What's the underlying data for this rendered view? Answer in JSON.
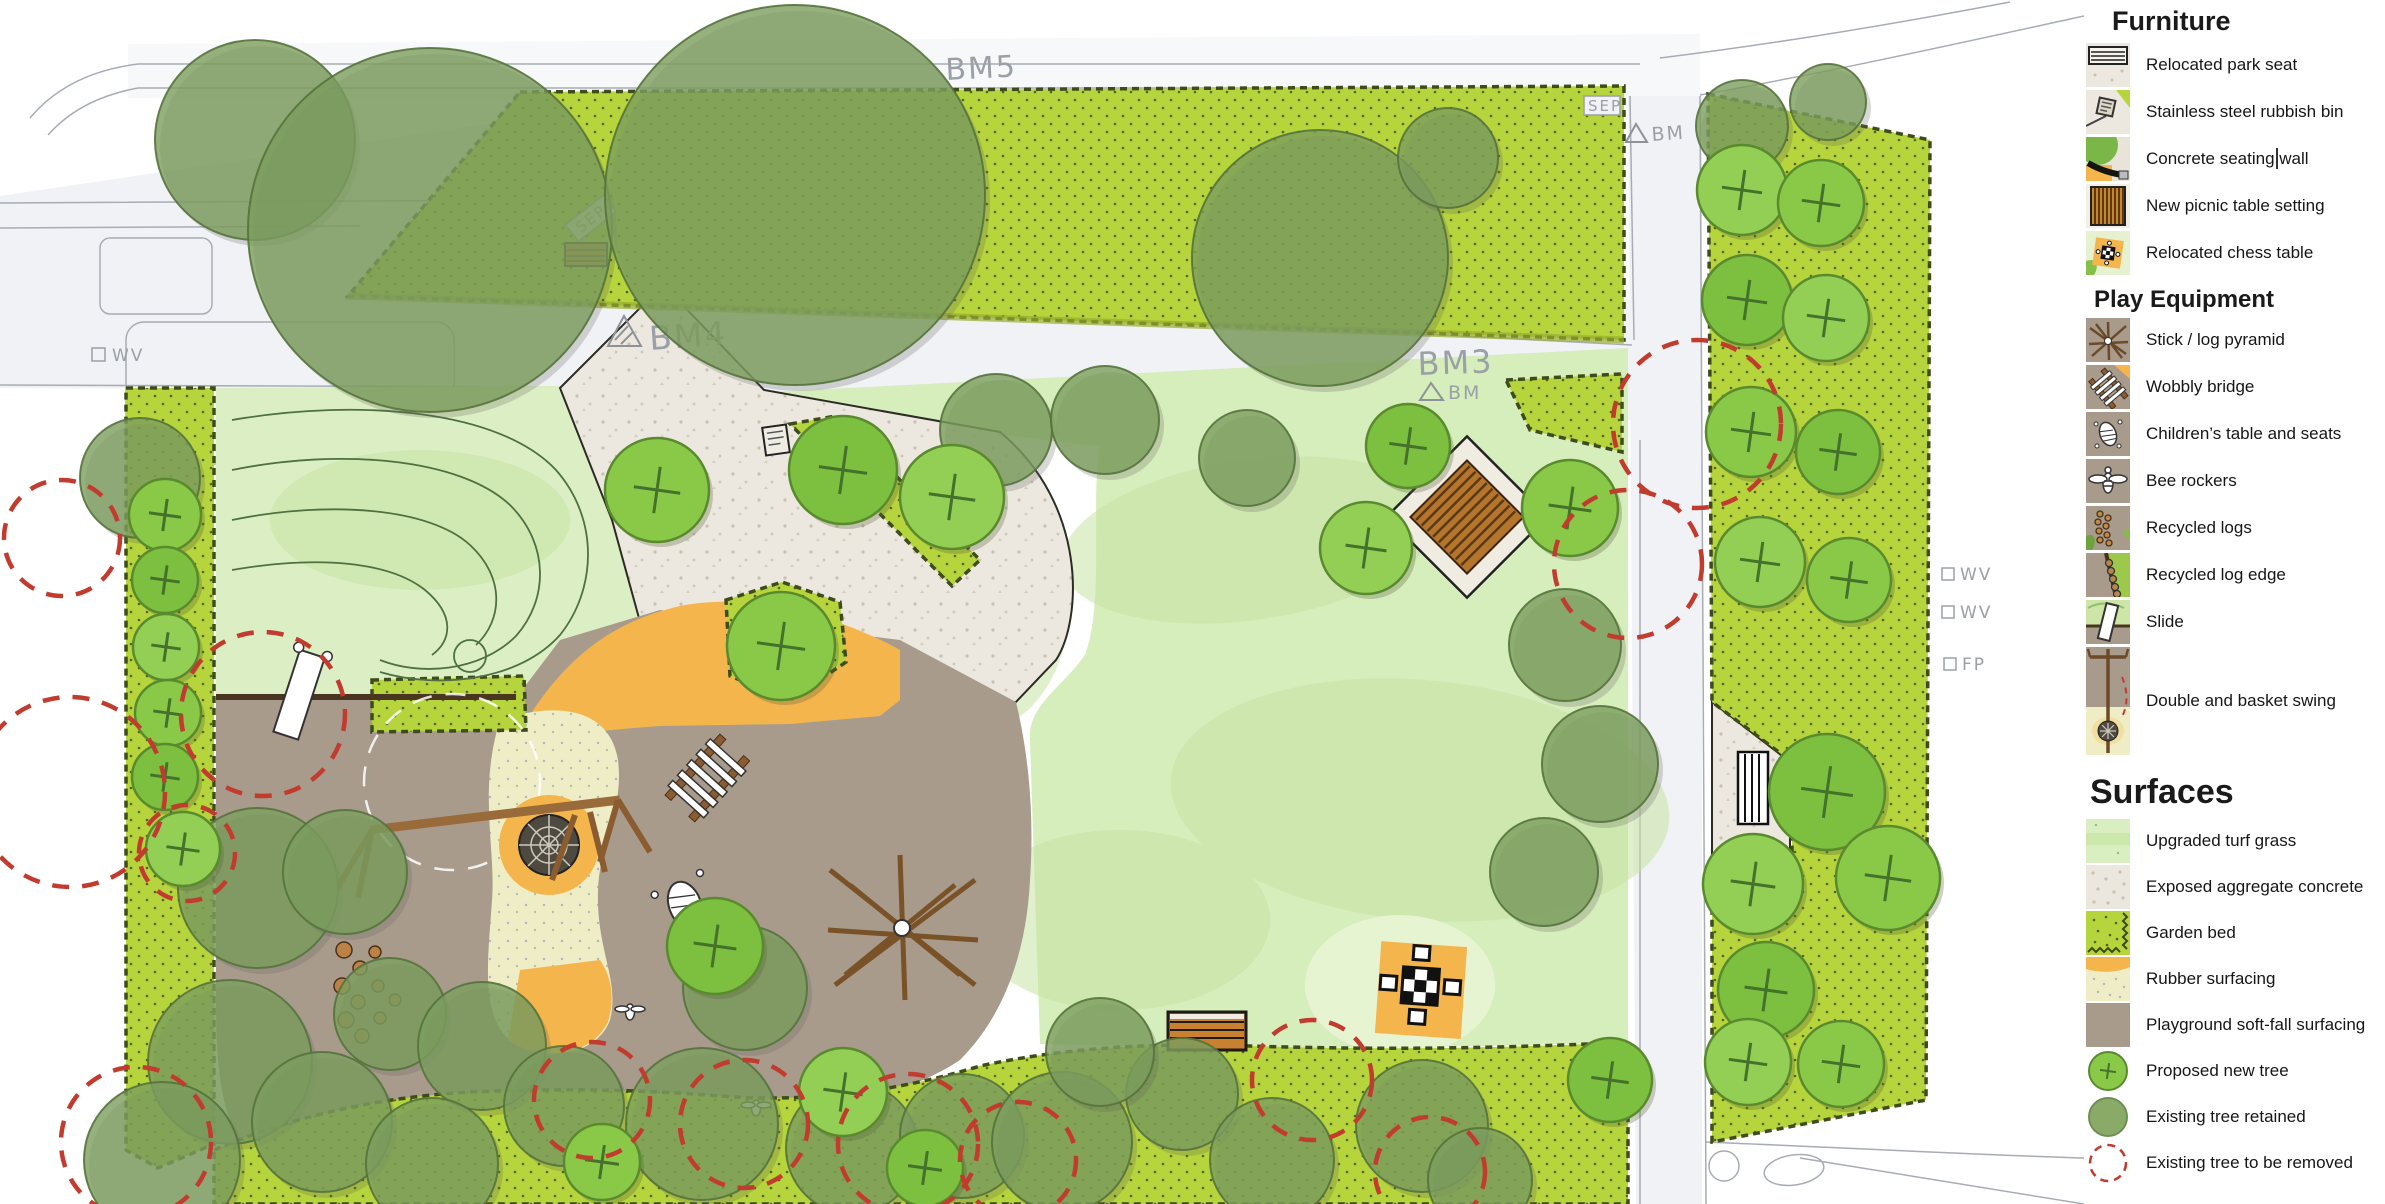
{
  "map": {
    "labels": {
      "bm5": "BM5",
      "bm4": "BM4",
      "bm3": "BM3",
      "bm": "BM",
      "sep": "SEP",
      "wv": "WV",
      "fp": "FP"
    },
    "colors": {
      "garden_bed": "#b6d43b",
      "turf": "#dcefc4",
      "turf_central": "#d6edbc",
      "concrete": "#ece8df",
      "soft_fall": "#a89b8c",
      "rubber": "#efedc6",
      "orange": "#f5b54d",
      "road": "#f1f2f6",
      "proposed_tree": [
        "#8ac948",
        "#7dbf3f",
        "#93cf55"
      ],
      "proposed_tree_stroke": "#5a8a2e",
      "existing_tree": "rgba(124,158,94,0.8)",
      "existing_tree_stroke": "rgba(85,115,60,0.9)",
      "removed_tree": "#c13b2e",
      "label_gray": "#9aa0a6"
    },
    "trees": {
      "existing": [
        [
          255,
          140,
          100
        ],
        [
          430,
          230,
          182
        ],
        [
          795,
          195,
          190
        ],
        [
          1320,
          258,
          128
        ],
        [
          1448,
          158,
          50
        ],
        [
          996,
          430,
          56
        ],
        [
          1105,
          420,
          54
        ],
        [
          1247,
          458,
          48
        ],
        [
          1742,
          126,
          46
        ],
        [
          1828,
          102,
          38
        ],
        [
          140,
          478,
          60
        ],
        [
          258,
          888,
          80
        ],
        [
          1565,
          645,
          56
        ],
        [
          1600,
          764,
          58
        ],
        [
          1544,
          872,
          54
        ],
        [
          345,
          872,
          62
        ],
        [
          745,
          988,
          62
        ],
        [
          390,
          1014,
          56
        ],
        [
          482,
          1046,
          64
        ],
        [
          230,
          1062,
          82
        ],
        [
          162,
          1160,
          78
        ],
        [
          322,
          1122,
          70
        ],
        [
          432,
          1164,
          66
        ],
        [
          564,
          1106,
          60
        ],
        [
          702,
          1124,
          76
        ],
        [
          852,
          1148,
          66
        ],
        [
          962,
          1136,
          62
        ],
        [
          1062,
          1142,
          70
        ],
        [
          1182,
          1094,
          56
        ],
        [
          1272,
          1160,
          62
        ],
        [
          1100,
          1052,
          54
        ],
        [
          1422,
          1126,
          66
        ],
        [
          1480,
          1180,
          52
        ]
      ],
      "proposed": [
        [
          165,
          515,
          36
        ],
        [
          165,
          580,
          33
        ],
        [
          166,
          647,
          33
        ],
        [
          168,
          713,
          33
        ],
        [
          165,
          777,
          33
        ],
        [
          183,
          849,
          37
        ],
        [
          657,
          490,
          52
        ],
        [
          843,
          470,
          54
        ],
        [
          952,
          497,
          52
        ],
        [
          781,
          646,
          54
        ],
        [
          1408,
          446,
          42
        ],
        [
          1366,
          548,
          46
        ],
        [
          1570,
          508,
          48
        ],
        [
          715,
          946,
          48
        ],
        [
          1742,
          190,
          45
        ],
        [
          1821,
          203,
          43
        ],
        [
          1747,
          300,
          45
        ],
        [
          1826,
          318,
          43
        ],
        [
          1751,
          432,
          45
        ],
        [
          1838,
          452,
          42
        ],
        [
          1760,
          562,
          45
        ],
        [
          1849,
          580,
          42
        ],
        [
          1827,
          792,
          58
        ],
        [
          1753,
          884,
          50
        ],
        [
          1888,
          878,
          52
        ],
        [
          1766,
          990,
          48
        ],
        [
          1748,
          1062,
          43
        ],
        [
          1841,
          1064,
          43
        ],
        [
          1610,
          1080,
          42
        ],
        [
          843,
          1092,
          44
        ],
        [
          602,
          1162,
          38
        ],
        [
          925,
          1168,
          38
        ]
      ],
      "removed": [
        [
          62,
          538,
          58
        ],
        [
          70,
          792,
          95
        ],
        [
          263,
          714,
          82
        ],
        [
          187,
          853,
          48
        ],
        [
          136,
          1142,
          75
        ],
        [
          592,
          1100,
          58
        ],
        [
          744,
          1124,
          64
        ],
        [
          908,
          1144,
          70
        ],
        [
          1018,
          1160,
          58
        ],
        [
          1312,
          1080,
          60
        ],
        [
          1430,
          1172,
          55
        ],
        [
          1628,
          564,
          74
        ],
        [
          1697,
          424,
          84
        ]
      ]
    }
  },
  "legend": {
    "furniture": {
      "title": "Furniture",
      "items": [
        {
          "label": "Relocated park seat"
        },
        {
          "label": "Stainless steel rubbish bin"
        },
        {
          "label": "Concrete seating wall"
        },
        {
          "label": "New picnic table setting"
        },
        {
          "label": "Relocated chess table"
        }
      ]
    },
    "play_equipment": {
      "title": "Play Equipment",
      "items": [
        {
          "label": "Stick / log pyramid"
        },
        {
          "label": "Wobbly bridge"
        },
        {
          "label": "Children’s table and seats"
        },
        {
          "label": "Bee rockers"
        },
        {
          "label": "Recycled logs"
        },
        {
          "label": "Recycled log edge"
        },
        {
          "label": "Slide"
        },
        {
          "label": "Double and basket swing"
        }
      ]
    },
    "surfaces": {
      "title": "Surfaces",
      "items": [
        {
          "label": "Upgraded turf grass"
        },
        {
          "label": "Exposed aggregate concrete"
        },
        {
          "label": "Garden bed"
        },
        {
          "label": "Rubber surfacing"
        },
        {
          "label": "Playground soft-fall surfacing"
        },
        {
          "label": "Proposed new tree"
        },
        {
          "label": "Existing tree retained"
        },
        {
          "label": "Existing tree to be removed"
        }
      ]
    }
  }
}
